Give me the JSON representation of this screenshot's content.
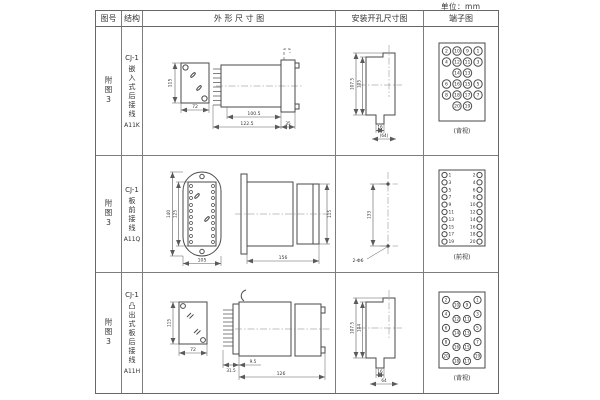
{
  "page": {
    "unit_label": "单位：mm"
  },
  "table": {
    "headers": {
      "fig_no": "图号",
      "structure": "结构",
      "outline": "外 形 尺 寸 图",
      "install": "安装开孔尺寸图",
      "terminal": "端子图"
    }
  },
  "rows": [
    {
      "fig_no": "附图3",
      "model": "CJ-1",
      "desc": "嵌入式后接线",
      "code": "A11K",
      "outline": {
        "front_h": "115",
        "front_w": "72",
        "d1": "100.5",
        "d2": "122.5",
        "d3": "35"
      },
      "install": {
        "h_outer": "107.5",
        "h_inner": "105",
        "w_slot": "16",
        "w_base": "(64)"
      },
      "terminal": {
        "view": "(背视)",
        "n": [
          "2",
          "10",
          "9",
          "1",
          "4",
          "12",
          "11",
          "3",
          "14",
          "13",
          "6",
          "16",
          "15",
          "5",
          "8",
          "18",
          "17",
          "7",
          "20",
          "19"
        ]
      }
    },
    {
      "fig_no": "附图3",
      "model": "CJ-1",
      "desc": "板前接线",
      "code": "A11Q",
      "outline": {
        "front_h_outer": "140",
        "front_h_inner": "125",
        "front_w": "105",
        "side_len": "156",
        "side_h": "115"
      },
      "install": {
        "h": "133",
        "holes": "2-Φ6"
      },
      "terminal": {
        "view": "(前视)",
        "left": [
          "1",
          "3",
          "5",
          "7",
          "9",
          "11",
          "13",
          "15",
          "17",
          "19"
        ],
        "right": [
          "2",
          "4",
          "6",
          "8",
          "10",
          "12",
          "14",
          "16",
          "18",
          "20"
        ]
      }
    },
    {
      "fig_no": "附图3",
      "model": "CJ-1",
      "desc": "凸出式板后接线",
      "code": "A11H",
      "outline": {
        "front_h": "115",
        "front_w": "72",
        "d1": "31.5",
        "d2": "9.5",
        "d3": "126"
      },
      "install": {
        "h_outer": "107.5",
        "h_inner": "104",
        "w_slot": "16",
        "w_base": "64"
      },
      "terminal": {
        "view": "(背视)",
        "n": [
          "2",
          "4",
          "6",
          "8",
          "20",
          "10",
          "12",
          "14",
          "16",
          "18",
          "9",
          "11",
          "13",
          "15",
          "17",
          "1",
          "3",
          "5",
          "7",
          "19"
        ]
      }
    }
  ]
}
